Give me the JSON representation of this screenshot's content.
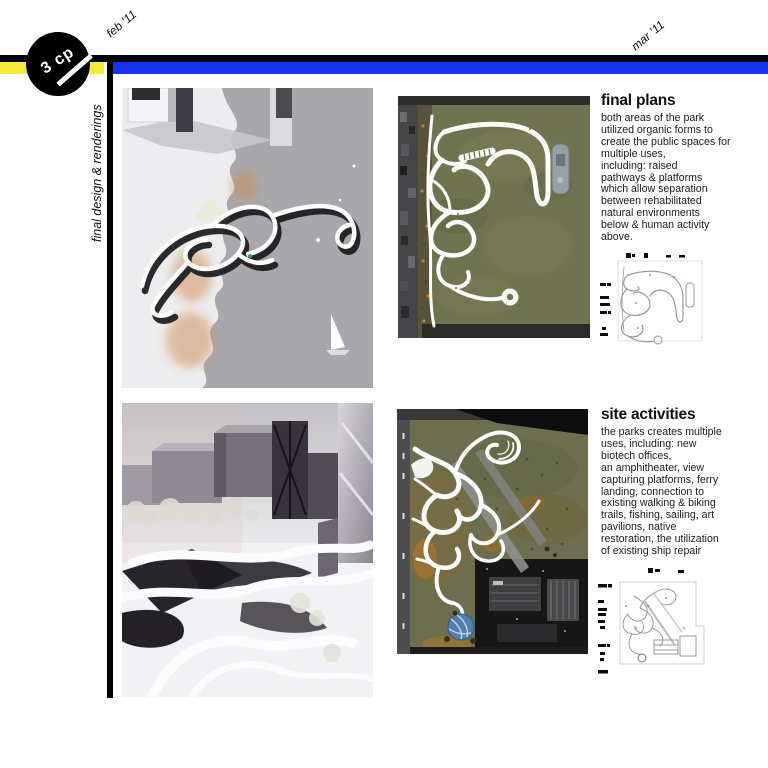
{
  "timeline": {
    "badge_label": "3 cp",
    "month_left": "feb '11",
    "month_right": "mar '11"
  },
  "sidebar_title": "final design & renderings",
  "colors": {
    "accent_blue": "#1733f2",
    "accent_yellow": "#f6ea3c",
    "bar_black": "#000000"
  },
  "sections": {
    "final_plans": {
      "heading": "final plans",
      "body": "both areas of the park\nutilized organic forms to\ncreate the public spaces for\nmultiple uses,\nincluding: raised\npathways & platforms\nwhich allow separation\nbetween rehabilitated\nnatural environments\nbelow & human activity\nabove."
    },
    "site_activities": {
      "heading": "site activities",
      "body": "the parks creates multiple\nuses, including: new\nbiotech offices,\nan amphitheater, view\ncapturing platforms, ferry\nlanding, connection to\nexisting walking & biking\ntrails, fishing, sailing, art\npavilions, native\nrestoration, the utilization\nof existing ship repair"
    }
  }
}
